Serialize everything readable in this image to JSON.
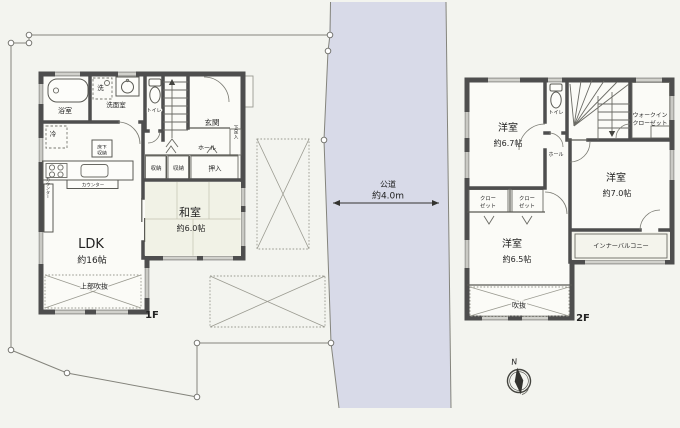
{
  "site": {
    "road": {
      "name": "公道",
      "width": "約4.0m"
    },
    "compass_north": "N"
  },
  "floor1": {
    "tag": "1F",
    "ldk": {
      "name": "LDK",
      "size": "約16帖"
    },
    "washitsu": {
      "name": "和室",
      "size": "約6.0帖"
    },
    "labels": {
      "bath": "浴室",
      "laundry": "洗",
      "washroom": "洗面室",
      "toilet": "トイレ",
      "entrance": "玄関",
      "hall": "ホール",
      "shoe_cabinet": "下足入",
      "storage": "収納",
      "oshiire": "押入",
      "fridge": "冷",
      "underfloor_l1": "床下",
      "underfloor_l2": "収納",
      "counter": "カウンター",
      "upper_void": "上部吹抜"
    }
  },
  "floor2": {
    "tag": "2F",
    "rooms": [
      {
        "name": "洋室",
        "size": "約6.7帖"
      },
      {
        "name": "洋室",
        "size": "約7.0帖"
      },
      {
        "name": "洋室",
        "size": "約6.5帖"
      }
    ],
    "labels": {
      "toilet": "トイレ",
      "hall": "ホール",
      "wic_l1": "ウォークイン",
      "wic_l2": "クローゼット",
      "closet_l1": "クロー",
      "closet_l2": "ゼット",
      "inner_balcony": "インナーバルコニー",
      "void": "吹抜"
    }
  },
  "colors": {
    "site_fill": "#e7ede8",
    "road_fill": "#d8dae8",
    "wall": "#4e4e4e",
    "closet_tan": "#d9cab1",
    "tatami": "#f1f2e6",
    "room_fill": "#fbfbf7"
  }
}
